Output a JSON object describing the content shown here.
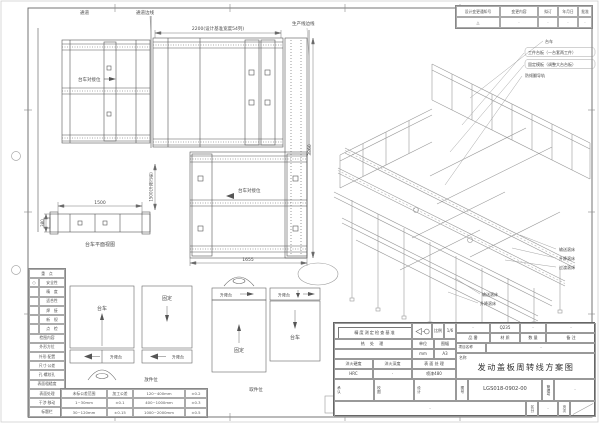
{
  "revision": {
    "headers": [
      "设计变更通知号",
      "变更内容",
      "拟订",
      "年月日",
      "批准"
    ],
    "row": [
      "△",
      "·",
      "·",
      "·",
      "·"
    ]
  },
  "plan": {
    "aisle": "通道",
    "aisle_edge": "通道边线",
    "prod_edge": "生产线边线",
    "dim_top": "2200(设计基准宽度54列)",
    "dock_label_a": "台车对接位",
    "dock_label_b": "台车对接位",
    "dim_bottom": "1655",
    "dim_right": "3860",
    "dim_lift": "1500(升降行程)",
    "side_dim_w": "1500",
    "side_dim_h": "380",
    "side_caption": "台车平面视图"
  },
  "iso": {
    "labels_top": [
      "台车",
      "工件台板（一台套两工件）",
      "固定模板（调整大台台板）",
      "防倾翻导轨"
    ],
    "labels_right": [
      "输送滚床",
      "升降滚床",
      "过渡滚床"
    ],
    "labels_left": [
      "输送滚床",
      "升降滚床"
    ]
  },
  "legend": {
    "title": "重　点",
    "sym": "○",
    "rows": [
      "安全性",
      "精　度",
      "适合性",
      "焊　接",
      "新　规",
      "点　检"
    ],
    "section2": "检图内容",
    "rows2": [
      "外形方位",
      "外形·配置",
      "尺寸·公差",
      "孔·螺纹孔",
      "表面粗糙度",
      "表面处理",
      "干涉·移动",
      "标题栏"
    ]
  },
  "diagrams": {
    "box1": "台车",
    "box2": "固定",
    "box3": "固定",
    "box4": "台车",
    "lift": "升降台",
    "caption1": "放件位",
    "caption2": "取件位"
  },
  "tolerance": {
    "rows": [
      [
        "未标公差范围",
        "加工公差",
        "120~400mm",
        "±0.2"
      ],
      [
        "1~30mm",
        "±0.1",
        "400~1000mm",
        "±0.3"
      ],
      [
        "30~120mm",
        "±0.15",
        "1000~2000mm",
        "±0.5"
      ]
    ]
  },
  "titleblock": {
    "accuracy": "精度测定检查基准",
    "scale_label": "比例",
    "scale_value": "1/6",
    "heat": "热 处 理",
    "unit_label": "单位",
    "unit_value": "mm",
    "sheet_label": "图幅",
    "sheet_value": "A3",
    "hrd_label": "淬火硬度",
    "hrd_value": "HRC",
    "dep_label": "淬火深度",
    "dep_value": "·",
    "surf_label": "表 面 处 理",
    "surf_value": "喷漆480",
    "pn_label": "品 番",
    "pn_value": "·",
    "mat_label": "材 质",
    "mat_value": "Q235",
    "qty_label": "数 量",
    "qty_value": "·",
    "rem_label": "备 注",
    "rem_value": "·",
    "proj_label": "项目名称",
    "proj_value": "·",
    "name_label": "名称",
    "title": "发动盖板周转线方案图",
    "approve": "承认",
    "check": "校图",
    "design": "设计",
    "dwg_label": "图号",
    "dwg_no": "LGS018-0902-00",
    "mgmt_label": "管理号",
    "mgmt_value": "·",
    "note": "·",
    "class_label": "区分",
    "class_value": "·",
    "page_label": "页次"
  }
}
